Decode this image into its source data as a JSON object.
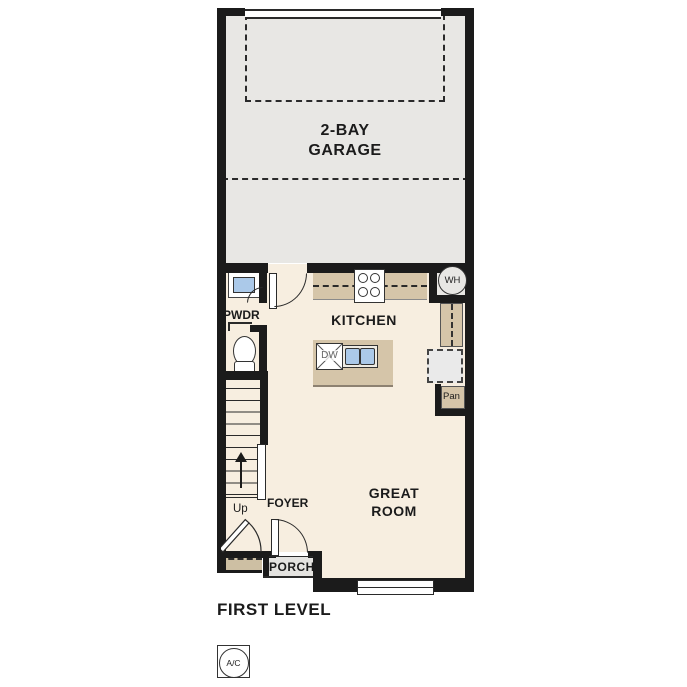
{
  "plan": {
    "title": "FIRST LEVEL",
    "labels": {
      "garage_line1": "2-BAY",
      "garage_line2": "GARAGE",
      "kitchen": "KITCHEN",
      "great_room_line1": "GREAT",
      "great_room_line2": "ROOM",
      "powder": "PWDR",
      "foyer": "FOYER",
      "porch": "PORCH",
      "pantry": "Pan",
      "stairs_direction": "Up"
    },
    "fixtures": {
      "water_heater": "WH",
      "dishwasher": "DW",
      "ac_unit": "A/C"
    }
  },
  "colors": {
    "wall": "#1b1b1b",
    "line": "#2a2a2a",
    "garage-floor": "#e8e7e4",
    "interior-floor": "#f7eee0",
    "counter": "#d5c5a9",
    "stoop": "#cdbfa3",
    "porch-floor": "#e4e3e0",
    "fixture-blue": "#abc9e9",
    "fridge-gray": "#eaeaea"
  }
}
